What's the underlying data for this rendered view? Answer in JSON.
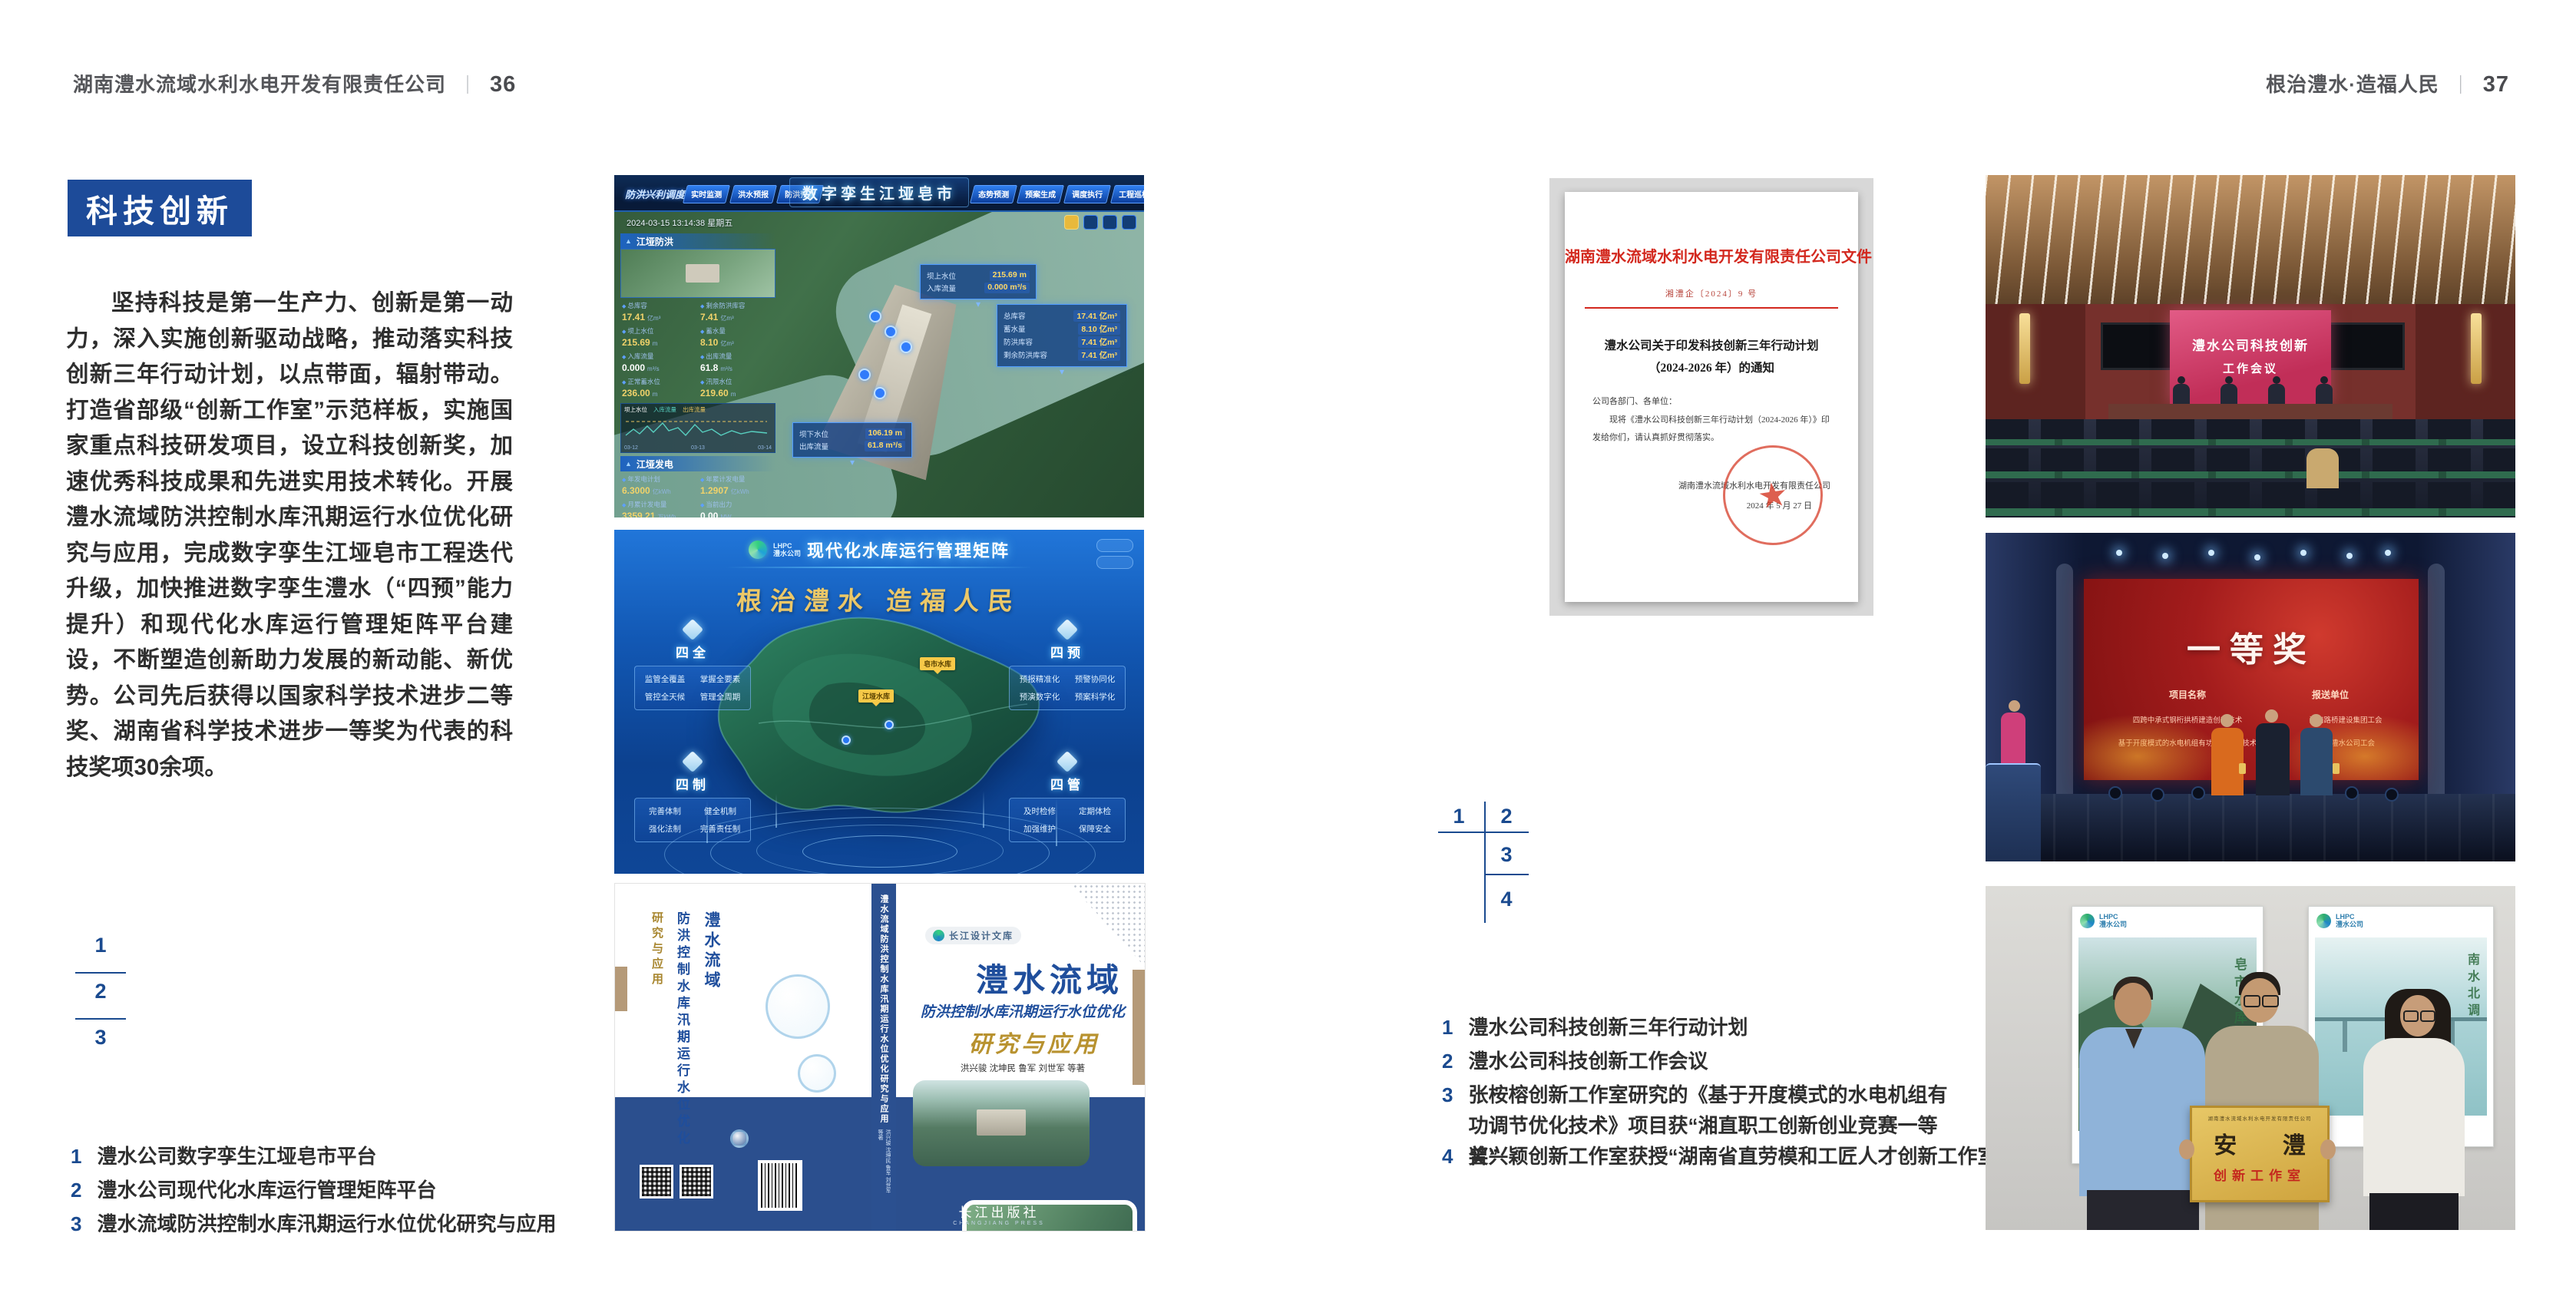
{
  "colors": {
    "accent_blue": "#1d4b99",
    "index_blue": "#1a4a8f",
    "doc_red": "#d3281e",
    "book_band_blue": "#2b4f8e"
  },
  "page_left": {
    "header": {
      "company": "湖南澧水流域水利水电开发有限责任公司",
      "divider": "｜",
      "page_no": "36"
    },
    "badge": "科技创新",
    "body": "坚持科技是第一生产力、创新是第一动力，深入实施创新驱动战略，推动落实科技创新三年行动计划，以点带面，辐射带动。打造省部级“创新工作室”示范样板，实施国家重点科技研发项目，设立科技创新奖，加速优秀科技成果和先进实用技术转化。开展澧水流域防洪控制水库汛期运行水位优化研究与应用，完成数字孪生江垭皂市工程迭代升级，加快推进数字孪生澧水（“四预”能力提升）和现代化水库运行管理矩阵平台建设，不断塑造创新助力发展的新动能、新优势。公司先后获得以国家科学技术进步二等奖、湖南省科学技术进步一等奖为代表的科技奖项30余项。",
    "figure_index": [
      "1",
      "2",
      "3"
    ],
    "captions": [
      {
        "no": "1",
        "text": "澧水公司数字孪生江垭皂市平台"
      },
      {
        "no": "2",
        "text": "澧水公司现代化水库运行管理矩阵平台"
      },
      {
        "no": "3",
        "text": "澧水流域防洪控制水库汛期运行水位优化研究与应用"
      }
    ]
  },
  "page_right": {
    "header": {
      "slogan": "根治澧水·造福人民",
      "divider": "｜",
      "page_no": "37"
    },
    "figure_index": [
      "1",
      "2",
      "3",
      "4"
    ],
    "captions": [
      {
        "no": "1",
        "text": "澧水公司科技创新三年行动计划"
      },
      {
        "no": "2",
        "text": "澧水公司科技创新工作会议"
      },
      {
        "no": "3",
        "text": "张桉榕创新工作室研究的《基于开度模式的水电机组有功调节优化技术》项目获“湘直职工创新创业竞赛一等奖”"
      },
      {
        "no": "4",
        "text": "曾兴颖创新工作室获授“湖南省直劳模和工匠人才创新工作室”"
      }
    ]
  },
  "fig_twin": {
    "mode_label": "防洪兴利调度",
    "title": "数字孪生江垭皂市",
    "tabs_left": [
      "实时监测",
      "洪水预报",
      "防洪预警"
    ],
    "tabs_right": [
      "态势预测",
      "预案生成",
      "调度执行",
      "工程巡检"
    ],
    "datetime": "2024-03-15 13:14:38 星期五",
    "flood_panel": {
      "title": "江垭防洪",
      "stats": [
        {
          "l": "总库容",
          "v": "17.41",
          "u": "亿m³"
        },
        {
          "l": "剩余防洪库容",
          "v": "7.41",
          "u": "亿m³"
        },
        {
          "l": "坝上水位",
          "v": "215.69",
          "u": "m"
        },
        {
          "l": "蓄水量",
          "v": "8.10",
          "u": "亿m³"
        },
        {
          "l": "入库流量",
          "v": "0.000",
          "u": "m³/s"
        },
        {
          "l": "出库流量",
          "v": "61.8",
          "u": "m³/s"
        },
        {
          "l": "正常蓄水位",
          "v": "236.00",
          "u": "m"
        },
        {
          "l": "汛限水位",
          "v": "219.60",
          "u": "m"
        }
      ],
      "legend": [
        "坝上水位",
        "入库流量",
        "出库流量"
      ],
      "chart_ticks": [
        "03-12",
        "03-13",
        "03-14"
      ]
    },
    "power_panel": {
      "title": "江垭发电",
      "stats": [
        {
          "l": "年发电计划",
          "v": "6.3000",
          "u": "亿kWh"
        },
        {
          "l": "年累计发电量",
          "v": "1.2907",
          "u": "亿kWh"
        },
        {
          "l": "月累计发电量",
          "v": "3359.21",
          "u": "万kWh"
        },
        {
          "l": "当前出力",
          "v": "0.00",
          "u": "MW"
        },
        {
          "l": "发电流量",
          "v": "0.00",
          "u": "m³/s"
        },
        {
          "l": "泄水流量",
          "v": "0.00",
          "u": "m³/s"
        }
      ],
      "gauge_values": [
        "0.00",
        "102.98",
        "0.00"
      ]
    },
    "callout_up": [
      {
        "l": "坝上水位",
        "v": "215.69 m"
      },
      {
        "l": "入库流量",
        "v": "0.000 m³/s"
      }
    ],
    "callout_cap": [
      {
        "l": "总库容",
        "v": "17.41 亿m³"
      },
      {
        "l": "蓄水量",
        "v": "8.10 亿m³"
      },
      {
        "l": "防洪库容",
        "v": "7.41 亿m³"
      },
      {
        "l": "剩余防洪库容",
        "v": "7.41 亿m³"
      }
    ],
    "callout_down": [
      {
        "l": "坝下水位",
        "v": "106.19 m"
      },
      {
        "l": "出库流量",
        "v": "61.8 m³/s"
      }
    ]
  },
  "fig_matrix": {
    "logo_abbr": "LHPC",
    "logo_cn": "澧水公司",
    "title": "现代化水库运行管理矩阵",
    "slogan": "根治澧水 造福人民",
    "panels": [
      {
        "name": "四全",
        "items": [
          "监管全覆盖",
          "掌握全要素",
          "管控全天候",
          "管理全周期"
        ]
      },
      {
        "name": "四预",
        "items": [
          "预报精准化",
          "预警协同化",
          "预演数字化",
          "预案科学化"
        ]
      },
      {
        "name": "四制",
        "items": [
          "完善体制",
          "健全机制",
          "强化法制",
          "完善责任制"
        ]
      },
      {
        "name": "四管",
        "items": [
          "及时检修",
          "定期体检",
          "加强维护",
          "保障安全"
        ]
      }
    ],
    "markers": [
      "皂市水库",
      "江垭水库"
    ]
  },
  "fig_book": {
    "series_badge": "长江设计文库",
    "title_main": "澧水流域",
    "title_sub": "防洪控制水库汛期运行水位优化",
    "title_tail": "研究与应用",
    "authors": "洪兴骏 沈坤民 鲁军 刘世军 等著",
    "spine_text": "澧水流域防洪控制水库汛期运行水位优化研究与应用",
    "publisher": "长江出版社",
    "publisher_en": "CHANGJIANG PRESS"
  },
  "photo_doc": {
    "header": "湖南澧水流域水利水电开发有限责任公司文件",
    "doc_no": "湘澧企〔2024〕9 号",
    "title": "澧水公司关于印发科技创新三年行动计划（2024-2026 年）的通知",
    "salutation": "公司各部门、各单位：",
    "body": "现将《澧水公司科技创新三年行动计划（2024-2026 年）》印发给你们，请认真抓好贯彻落实。",
    "signer": "湖南澧水流域水利水电开发有限责任公司",
    "date": "2024 年 5 月 27 日"
  },
  "photo_meeting": {
    "screen_line1": "澧水公司科技创新",
    "screen_line2": "工作会议"
  },
  "photo_award": {
    "screen_title": "一等奖",
    "col_project": "项目名称",
    "col_unit": "报送单位",
    "rows": [
      {
        "project": "四跨中承式钢桁拱桥建造创新技术",
        "unit": "湖南路桥建设集团工会"
      },
      {
        "project": "基于开度模式的水电机组有功调节优化技术",
        "unit": "湖南澧水公司工会"
      }
    ]
  },
  "photo_plaque": {
    "poster_left_title": "皂市水库",
    "poster_right_title": "南水北调",
    "logo_abbr": "LHPC",
    "logo_cn": "澧水公司",
    "plaque_org": "湖南澧水流域水利水电开发有限责任公司",
    "plaque_name": "安 澧",
    "plaque_sub": "创新工作室"
  }
}
